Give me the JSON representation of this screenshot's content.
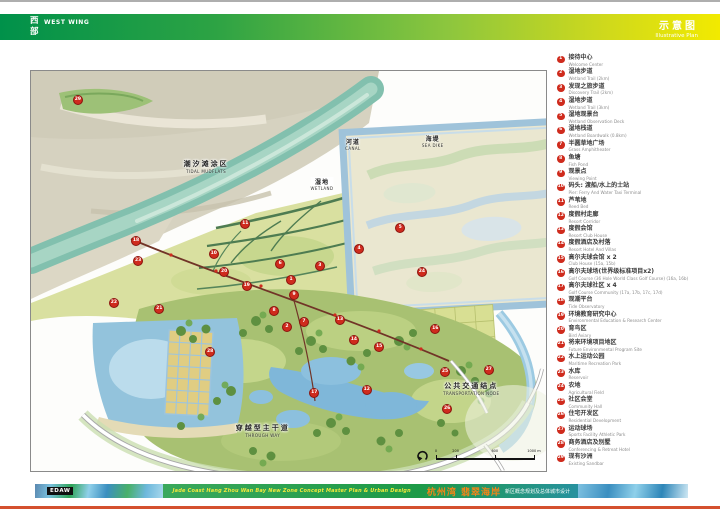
{
  "header": {
    "left_cn": "西部",
    "left_en": "WEST WING",
    "right_cn": "示意图",
    "right_en": "Illustrative Plan"
  },
  "map": {
    "labels": {
      "tidal": {
        "cn": "潮汐滩涂区",
        "en": "TIDAL MUDFLATS"
      },
      "wetland": {
        "cn": "湿地",
        "en": "WETLAND"
      },
      "canal": {
        "cn": "河道",
        "en": "CANAL"
      },
      "seadike": {
        "cn": "海堤",
        "en": "SEA DIKE"
      },
      "transport": {
        "cn": "公共交通结点",
        "en": "TRANSPORTATION NODE"
      },
      "throughway": {
        "cn": "穿越型主干道",
        "en": "THROUGH WAY"
      }
    },
    "scalebar": {
      "ticks": [
        {
          "label": "0",
          "pos": 0
        },
        {
          "label": "200",
          "pos": 20
        },
        {
          "label": "600",
          "pos": 60
        },
        {
          "label": "1000 m",
          "pos": 100
        }
      ]
    },
    "markers": [
      {
        "n": "1",
        "x": 50.3,
        "y": 52.0
      },
      {
        "n": "2",
        "x": 49.5,
        "y": 63.8
      },
      {
        "n": "3",
        "x": 55.9,
        "y": 48.5
      },
      {
        "n": "4",
        "x": 63.5,
        "y": 44.3
      },
      {
        "n": "5",
        "x": 71.5,
        "y": 39.0
      },
      {
        "n": "6",
        "x": 48.2,
        "y": 48.0
      },
      {
        "n": "7",
        "x": 52.8,
        "y": 62.5
      },
      {
        "n": "8",
        "x": 47.0,
        "y": 59.8
      },
      {
        "n": "9",
        "x": 50.9,
        "y": 55.8
      },
      {
        "n": "10",
        "x": 35.3,
        "y": 45.5
      },
      {
        "n": "11",
        "x": 41.4,
        "y": 38.0
      },
      {
        "n": "12",
        "x": 65.0,
        "y": 79.5
      },
      {
        "n": "13",
        "x": 59.8,
        "y": 62.0
      },
      {
        "n": "14",
        "x": 62.5,
        "y": 67.0
      },
      {
        "n": "15",
        "x": 67.4,
        "y": 68.8
      },
      {
        "n": "16",
        "x": 78.3,
        "y": 64.3
      },
      {
        "n": "17",
        "x": 54.8,
        "y": 80.3
      },
      {
        "n": "18",
        "x": 20.2,
        "y": 42.3
      },
      {
        "n": "19",
        "x": 41.7,
        "y": 53.5
      },
      {
        "n": "20",
        "x": 37.3,
        "y": 50.0
      },
      {
        "n": "21",
        "x": 24.7,
        "y": 59.3
      },
      {
        "n": "22",
        "x": 15.9,
        "y": 57.8
      },
      {
        "n": "23",
        "x": 20.6,
        "y": 47.3
      },
      {
        "n": "24",
        "x": 75.7,
        "y": 50.0
      },
      {
        "n": "25",
        "x": 80.2,
        "y": 75.0
      },
      {
        "n": "26",
        "x": 80.6,
        "y": 84.3
      },
      {
        "n": "27",
        "x": 88.7,
        "y": 74.5
      },
      {
        "n": "28",
        "x": 34.6,
        "y": 70.0
      },
      {
        "n": "29",
        "x": 8.9,
        "y": 7.0
      }
    ]
  },
  "legend": {
    "items": [
      {
        "n": "1",
        "cn": "接待中心",
        "en": "Welcome Center"
      },
      {
        "n": "2",
        "cn": "湿地步道",
        "en": "Wetland Trail (2km)"
      },
      {
        "n": "3",
        "cn": "发现之旅步道",
        "en": "Discovery Trail (2km)"
      },
      {
        "n": "4",
        "cn": "湿地步道",
        "en": "Wetland Trail (3km)"
      },
      {
        "n": "5",
        "cn": "湿地观景台",
        "en": "Wetland Observation Deck"
      },
      {
        "n": "6",
        "cn": "湿地栈道",
        "en": "Wetland Boardwalk (0.8km)"
      },
      {
        "n": "7",
        "cn": "半圆草地广场",
        "en": "Grass Amphitheater"
      },
      {
        "n": "8",
        "cn": "鱼塘",
        "en": "Fish Pond"
      },
      {
        "n": "9",
        "cn": "观景点",
        "en": "Viewing Point"
      },
      {
        "n": "10",
        "cn": "码头: 渡船/水上的士站",
        "en": "Pier: Ferry And Water Taxi Terminal"
      },
      {
        "n": "11",
        "cn": "芦苇地",
        "en": "Reed Bed"
      },
      {
        "n": "12",
        "cn": "度假村走廊",
        "en": "Resort Corridor"
      },
      {
        "n": "13",
        "cn": "度假会馆",
        "en": "Resort Club House"
      },
      {
        "n": "14",
        "cn": "度假酒店及村落",
        "en": "Resort Hotel And Villas"
      },
      {
        "n": "15",
        "cn": "高尔夫球会馆 x 2",
        "en": "Club House (15a, 15b)"
      },
      {
        "n": "16",
        "cn": "高尔夫球场(世界级标准项目x2)",
        "en": "Golf Course (36 Hole World Class Golf Course) (16a, 16b)"
      },
      {
        "n": "17",
        "cn": "高尔夫球社区 x 4",
        "en": "Golf Course Community (17a, 17b, 17c, 17d)"
      },
      {
        "n": "18",
        "cn": "观潮平台",
        "en": "Tide Observatory"
      },
      {
        "n": "19",
        "cn": "环境教育研究中心",
        "en": "Environmental Education & Research Center"
      },
      {
        "n": "20",
        "cn": "育鸟区",
        "en": "Bird Aviary"
      },
      {
        "n": "21",
        "cn": "将来环境项目地区",
        "en": "Future Environmental Program Site"
      },
      {
        "n": "22",
        "cn": "水上运动公园",
        "en": "Maritime Recreation Park"
      },
      {
        "n": "23",
        "cn": "水库",
        "en": "Reservoir"
      },
      {
        "n": "24",
        "cn": "农地",
        "en": "Agricultural Field"
      },
      {
        "n": "25",
        "cn": "社区会堂",
        "en": "Community Hall"
      },
      {
        "n": "26",
        "cn": "住宅开发区",
        "en": "Residential Development"
      },
      {
        "n": "27",
        "cn": "运动球场",
        "en": "Sports Facility Athletic Park"
      },
      {
        "n": "28",
        "cn": "商务酒店及别墅",
        "en": "Conferencing & Retreat Hotel"
      },
      {
        "n": "29",
        "cn": "现有沙洲",
        "en": "Existing Sandbar"
      }
    ]
  },
  "footer": {
    "logo": "EDAW",
    "subtitle_en": "Jade Coast Hang Zhou Wan Bay New Zone Concept Master Plan & Urban Design",
    "title_cn": "杭州湾 翡翠海岸",
    "subtitle_cn": "新区概念规划及总体城市设计"
  },
  "colors": {
    "header_green": "#00914a",
    "header_yellow": "#f2ea00",
    "marker_red": "#cf2b1d",
    "footer_orange": "#f08519",
    "bottom_rule_red": "#d4502e"
  }
}
